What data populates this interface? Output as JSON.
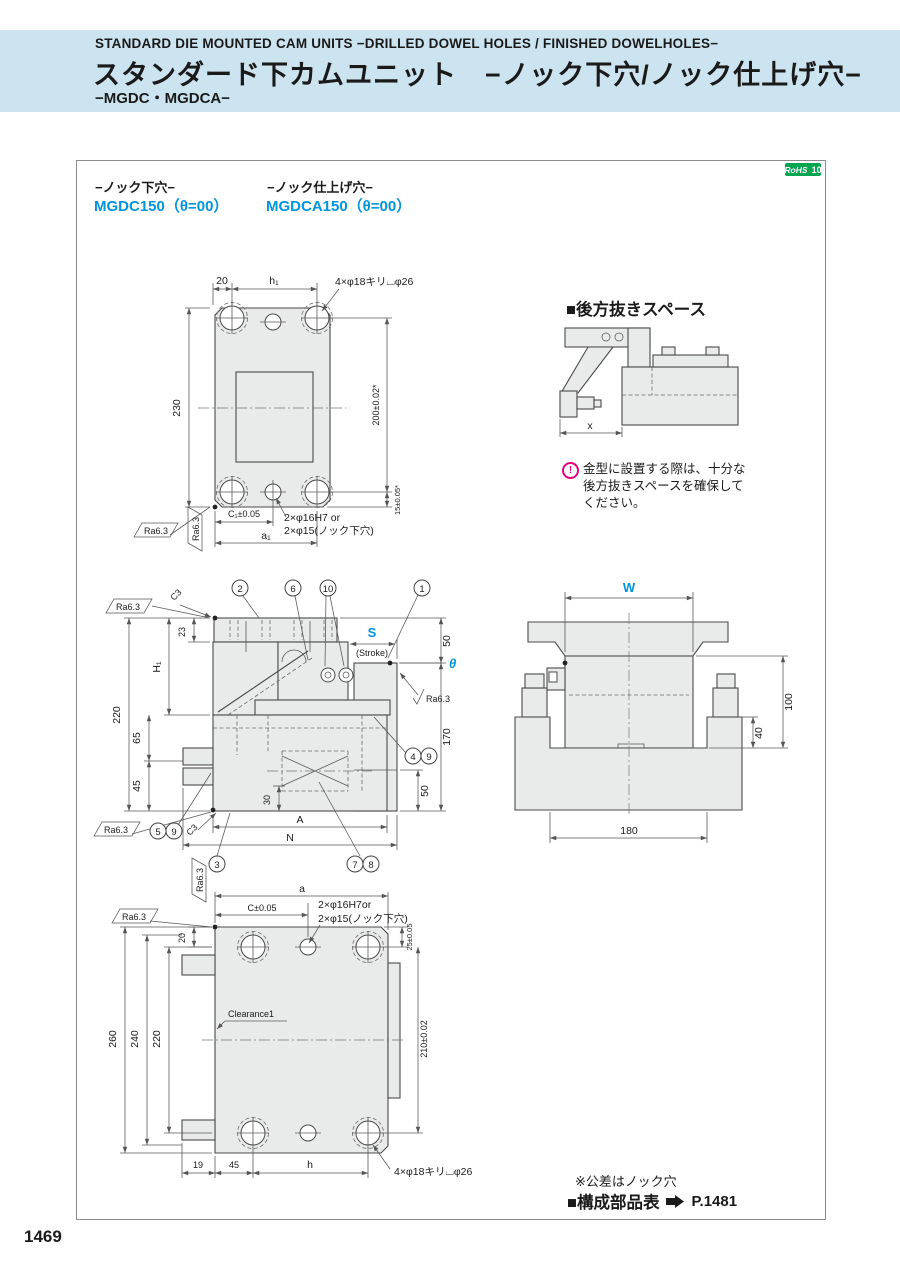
{
  "page_number": "1469",
  "header": {
    "en": "STANDARD DIE MOUNTED CAM UNITS −DRILLED DOWEL HOLES / FINISHED DOWELHOLES−",
    "jp": "スタンダード下カムユニット　−ノック下穴/ノック仕上げ穴−",
    "series": "−MGDC・MGDCA−"
  },
  "rohs": {
    "label": "RoHS",
    "num": "10"
  },
  "products": {
    "left_type": "−ノック下穴−",
    "left_model": "MGDC150（θ=00）",
    "right_type": "−ノック仕上げ穴−",
    "right_model": "MGDCA150（θ=00）"
  },
  "top_view": {
    "d20": "20",
    "h1": "h₁",
    "callout": "4×φ18キリ⌴φ26",
    "d230": "230",
    "d200": "200±0.02*",
    "d15": "15±0.05*",
    "c1": "C₁±0.05",
    "a1": "a₁",
    "dowel1": "2×φ16H7 or",
    "dowel2": "2×φ15(ノック下穴)",
    "ra": "Ra6.3"
  },
  "back_space": {
    "title": "■後方抜きスペース",
    "x": "x",
    "icon": "!",
    "note1": "金型に設置する際は、十分な",
    "note2": "後方抜きスペースを確保して",
    "note3": "ください。"
  },
  "front_view": {
    "d23": "23",
    "H1": "H₁",
    "d220": "220",
    "d65": "65",
    "d45": "45",
    "S": "S",
    "stroke": "(Stroke)",
    "d50_top": "50",
    "theta": "θ",
    "d170": "170",
    "d50_bot": "50",
    "d30": "30",
    "A": "A",
    "N": "N",
    "c3": "C3",
    "ra": "Ra6.3",
    "b1": "1",
    "b2": "2",
    "b3": "3",
    "b4": "4",
    "b5": "5",
    "b6": "6",
    "b7": "7",
    "b8": "8",
    "b9": "9",
    "b10": "10"
  },
  "side_view": {
    "W": "W",
    "d100": "100",
    "d40": "40",
    "d180": "180"
  },
  "bottom_view": {
    "a": "a",
    "c": "C±0.05",
    "dowel1": "2×φ16H7or",
    "dowel2": "2×φ15(ノック下穴)",
    "d20": "20",
    "d25": "25±0.05",
    "d210": "210±0.02",
    "d260": "260",
    "d240": "240",
    "d220": "220",
    "clearance": "Clearance1",
    "d19": "19",
    "d45": "45",
    "h": "h",
    "callout": "4×φ18キリ⌴φ26",
    "ra": "Ra6.3"
  },
  "footer": {
    "tolerance_note": "※公差はノック穴",
    "parts_table": "■構成部品表",
    "page_ref": "P.1481"
  }
}
